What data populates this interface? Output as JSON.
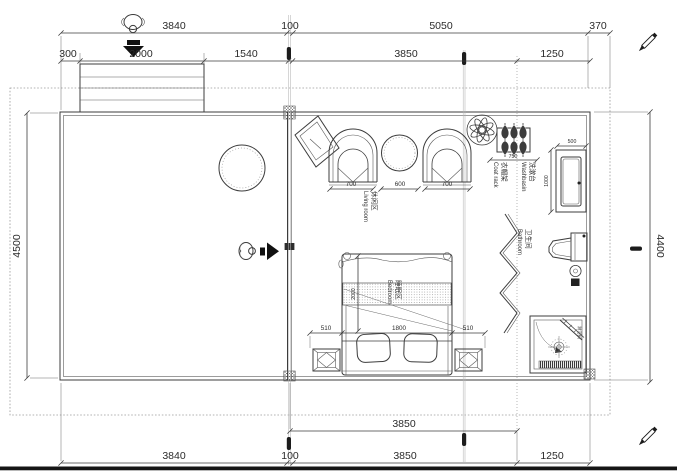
{
  "drawing": {
    "type": "architectural floor plan",
    "line_color": "#3c3c3c",
    "accent_black": "#151515"
  },
  "dims": {
    "top1": [
      "3840",
      "100",
      "5050",
      "370"
    ],
    "top2": [
      "300",
      "2000",
      "1540",
      "3850",
      "1250"
    ],
    "bottom1": [
      "3850"
    ],
    "bottom2": [
      "3840",
      "100",
      "3850",
      "1250"
    ],
    "left": "4500",
    "right": "4400",
    "living": [
      "700",
      "600",
      "700"
    ],
    "coat_rack": "750",
    "basin_w": "500",
    "basin_d": "1000",
    "bed_gap_left": "510",
    "bed_width": "1800",
    "bed_gap_right": "510",
    "bed_length": "2000"
  },
  "labels": {
    "living": {
      "zh": "休闲区",
      "en": "Living room"
    },
    "bedroom": {
      "zh": "睡眠区",
      "en": "Bedroom"
    },
    "coatrack": {
      "zh": "衣帽架",
      "en": "Coat rack"
    },
    "washbasin": {
      "zh": "洗漱台",
      "en": "Washbasin"
    },
    "bathroom": {
      "zh": "卫生间",
      "en": "Bathroom"
    },
    "shower": {
      "zh": "淋浴间"
    }
  },
  "icons": {
    "entry_top": "person-entering-down-icon",
    "entry_side": "person-entering-right-icon",
    "fan": "ceiling-fan-icon",
    "pen": "pen-marker-icon",
    "axis_marker": "axis-marker-icon"
  }
}
